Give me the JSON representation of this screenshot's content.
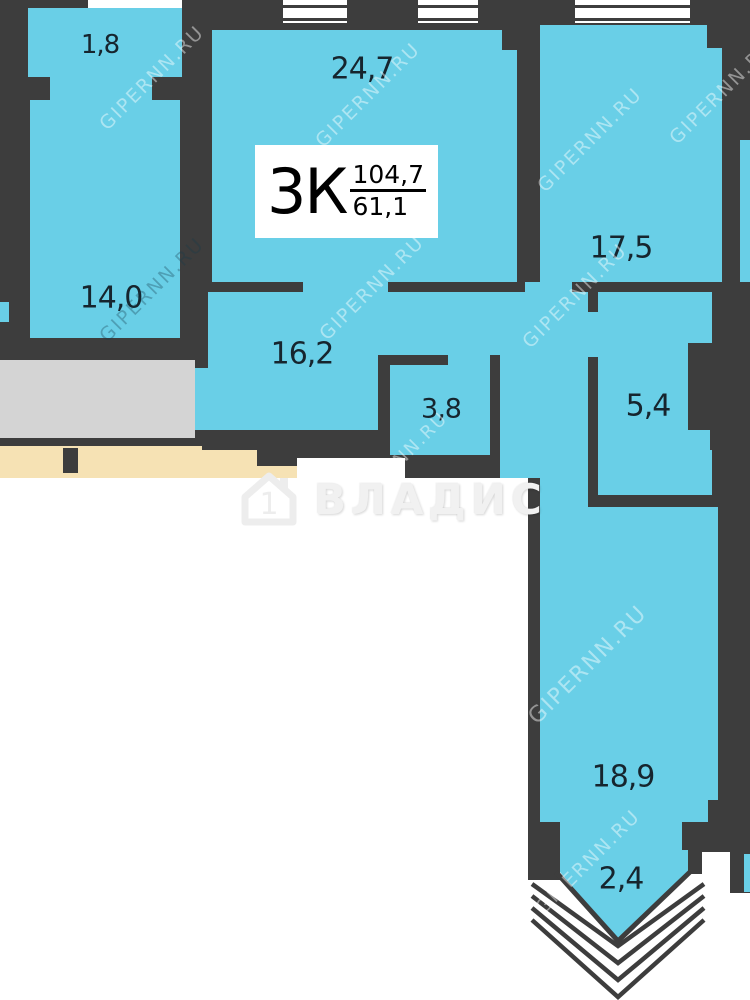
{
  "plan": {
    "type": "apartment-floor-plan",
    "title": {
      "rooms_label": "3К",
      "total_area": "104,7",
      "living_area": "61,1"
    },
    "rooms": [
      {
        "id": "balcony-top-left",
        "area_label": "1,8"
      },
      {
        "id": "living-room",
        "area_label": "24,7"
      },
      {
        "id": "bedroom-right",
        "area_label": "17,5"
      },
      {
        "id": "bedroom-left",
        "area_label": "14,0"
      },
      {
        "id": "hallway",
        "area_label": "16,2"
      },
      {
        "id": "bathroom",
        "area_label": "3,8"
      },
      {
        "id": "storage",
        "area_label": "5,4"
      },
      {
        "id": "bedroom-bottom",
        "area_label": "18,9"
      },
      {
        "id": "bay-balcony",
        "area_label": "2,4"
      }
    ],
    "watermarks": {
      "site": "GIPERNN.RU",
      "agency": "ВЛАДИС"
    },
    "colors": {
      "wall": "#3d3d3d",
      "room_fill": "#69cfe7",
      "common_area": "#d4d4d4",
      "corridor": "#f6e2b4",
      "label_text": "#16252e"
    }
  }
}
